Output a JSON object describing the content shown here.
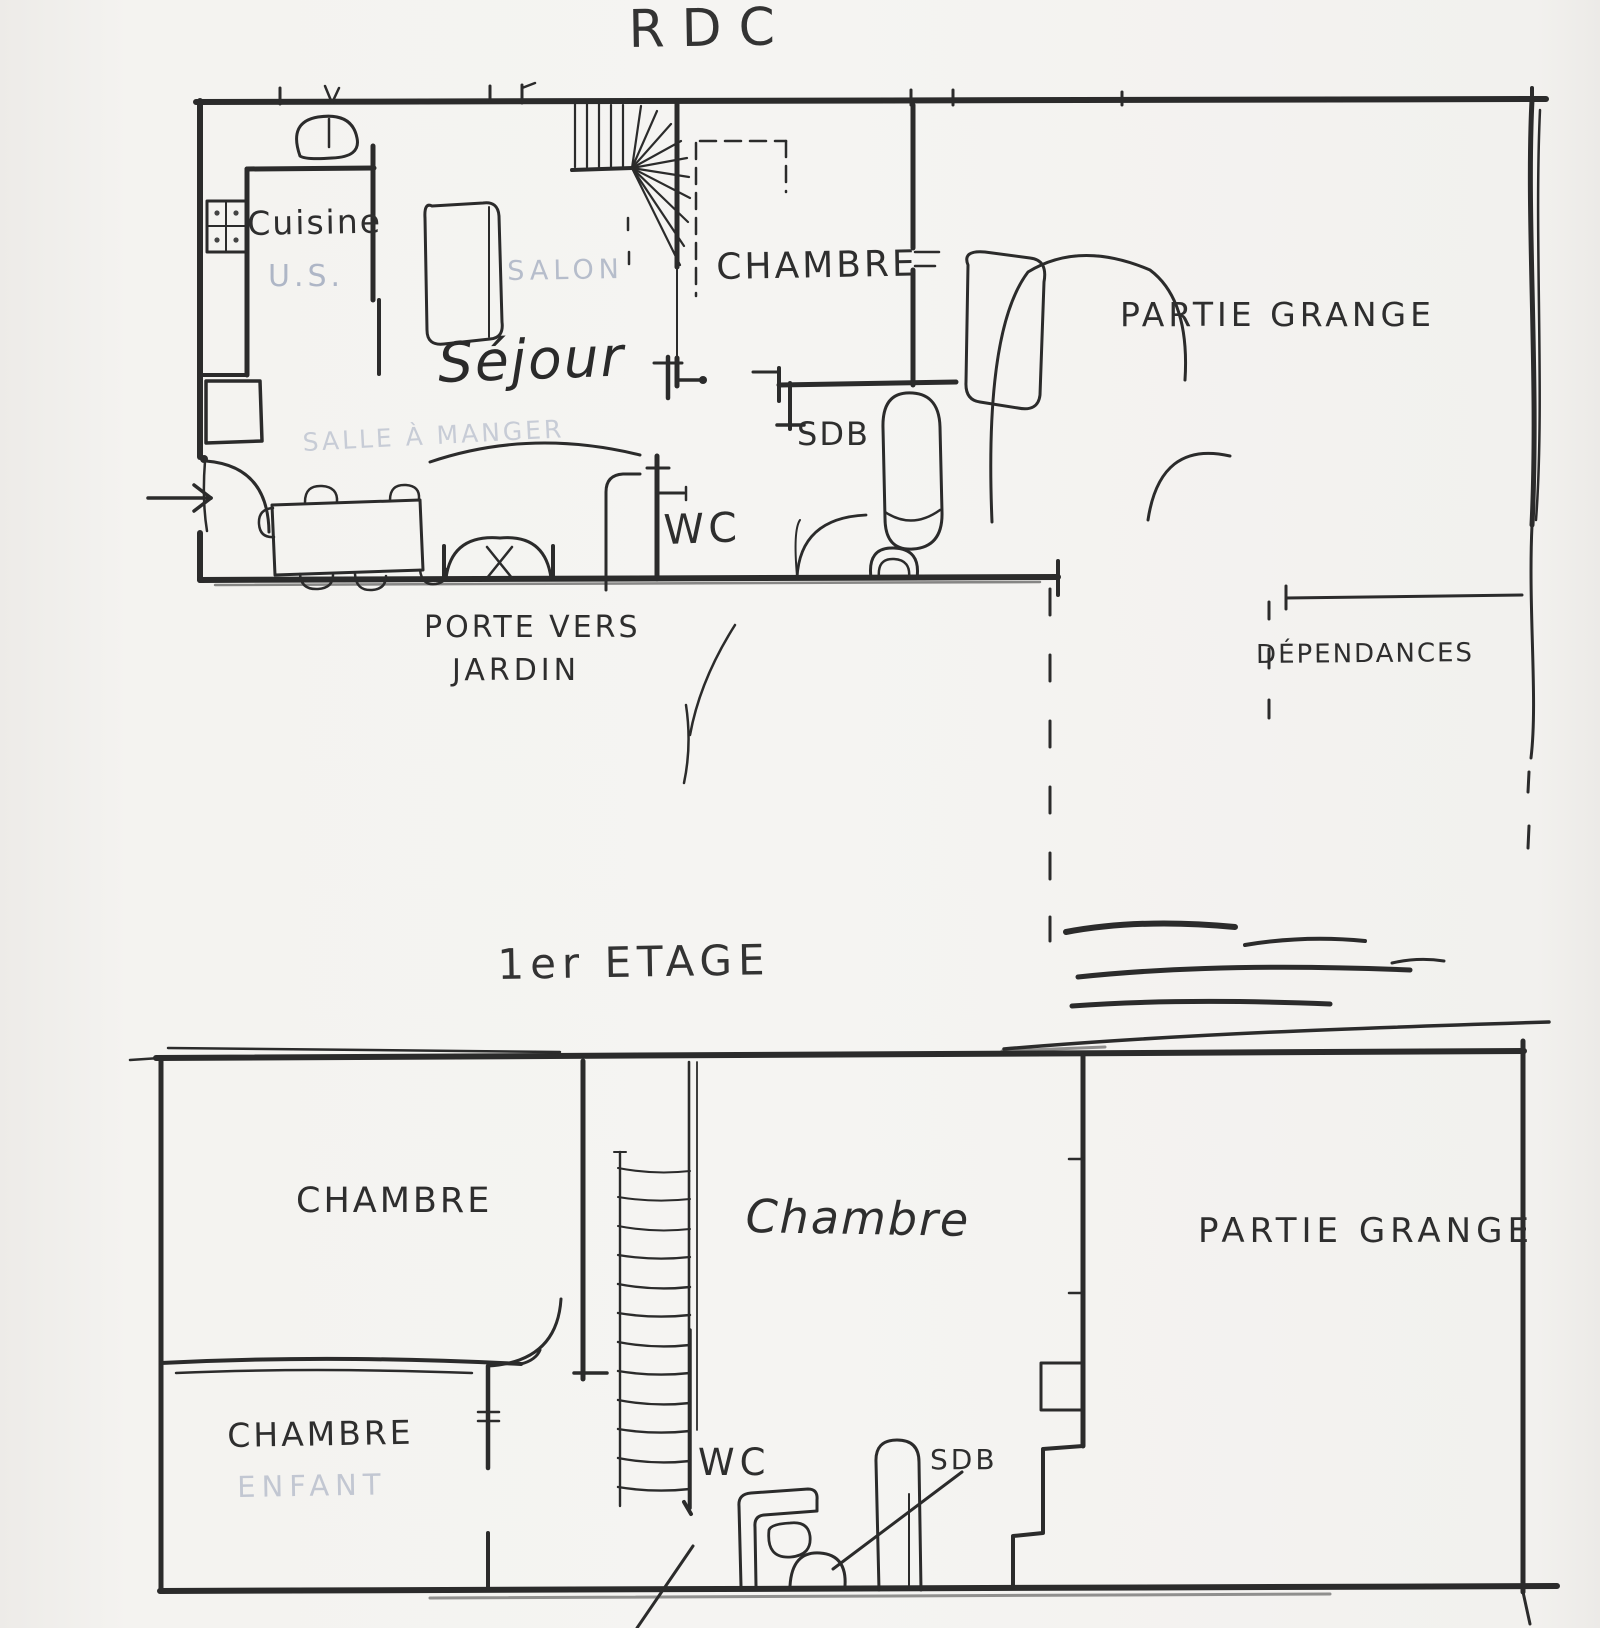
{
  "document": {
    "kind": "hand-drawn floor plan sketch"
  },
  "colors": {
    "ink": "#2b2b2b",
    "pencil_faint": "#c3c8d3",
    "paper": "#f5f4f2"
  },
  "floors": {
    "rdc": {
      "title": "RDC",
      "labels": {
        "cuisine": "Cuisine",
        "us": "U.S.",
        "salon": "SALON",
        "sejour": "Séjour",
        "chambre": "CHAMBRE",
        "sdb": "SDB",
        "wc": "WC",
        "partie_grange": "PARTIE GRANGE",
        "porte_vers": "PORTE VERS",
        "jardin": "JARDIN",
        "dependances": "DÉPENDANCES",
        "salle_a_manger": "SALLE À MANGER"
      }
    },
    "etage": {
      "title": "1er ETAGE",
      "labels": {
        "chambre_top_left": "CHAMBRE",
        "chambre_center": "Chambre",
        "chambre_bottom_left": "CHAMBRE",
        "enfant": "ENFANT",
        "wc": "WC",
        "sdb": "SDB",
        "partie_grange": "PARTIE GRANGE"
      }
    }
  }
}
